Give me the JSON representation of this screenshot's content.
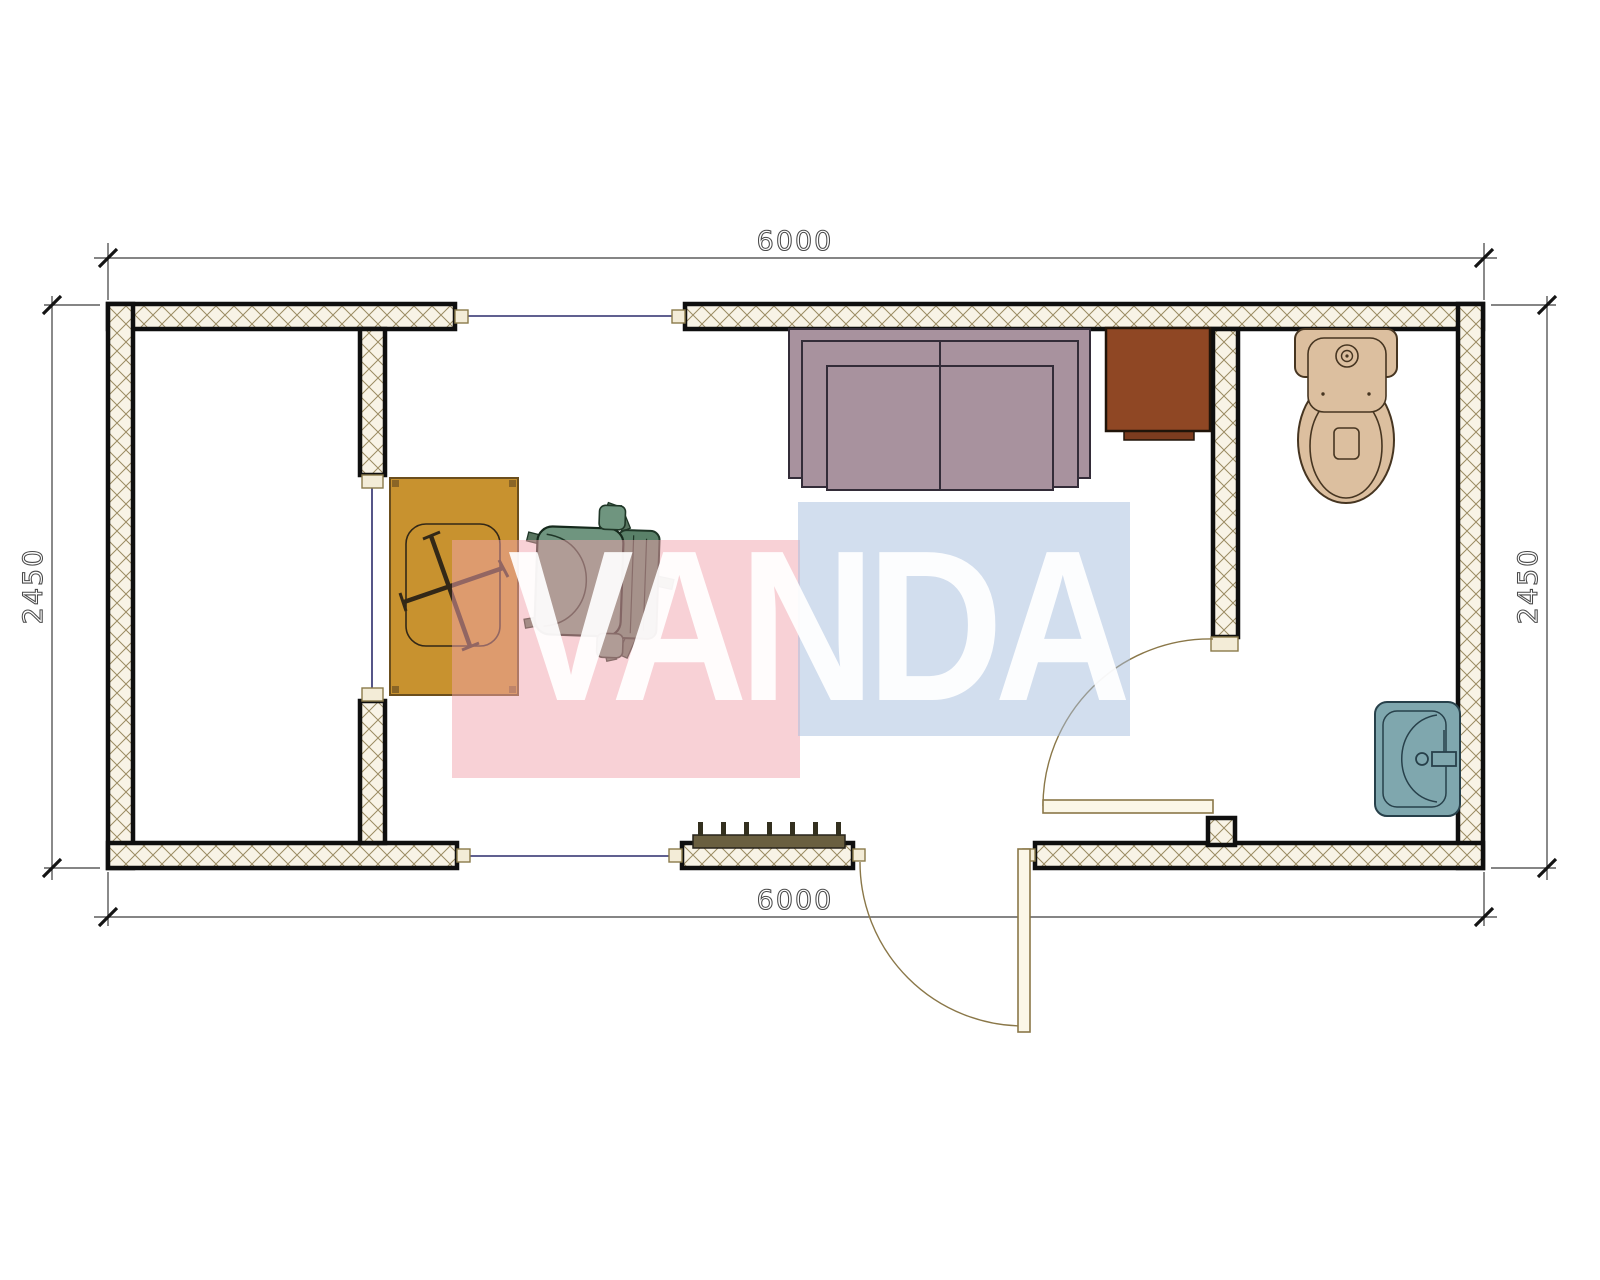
{
  "watermark": {
    "text": "VANDA",
    "pink_color": "#F2A3AD",
    "blue_color": "#A5BEDE",
    "text_color": "#FFFFFF"
  },
  "dimensions": {
    "top": "6000",
    "bottom": "6000",
    "left": "2450",
    "right": "2450"
  },
  "plan": {
    "wall_fill": "#F8F3E6",
    "wall_hatch_line": "#9B8B62",
    "wall_outline": "#0F0F0F",
    "opening_line_color": "#2B2B6B",
    "door_line_color": "#8A7748",
    "furniture": [
      {
        "name": "desk",
        "color": "#C8922F"
      },
      {
        "name": "office-chair",
        "color": "#6F957F"
      },
      {
        "name": "sofa",
        "color": "#A8929E"
      },
      {
        "name": "cabinet",
        "color": "#8F4724"
      },
      {
        "name": "radiator",
        "color": "#6A5F40"
      },
      {
        "name": "toilet",
        "color": "#DCBF9F"
      },
      {
        "name": "sink",
        "color": "#7FA7AE"
      }
    ],
    "doors": [
      {
        "name": "entrance-door"
      },
      {
        "name": "bathroom-door"
      }
    ],
    "windows": [
      {
        "name": "top-window"
      },
      {
        "name": "bottom-window"
      },
      {
        "name": "partition-opening"
      }
    ]
  }
}
